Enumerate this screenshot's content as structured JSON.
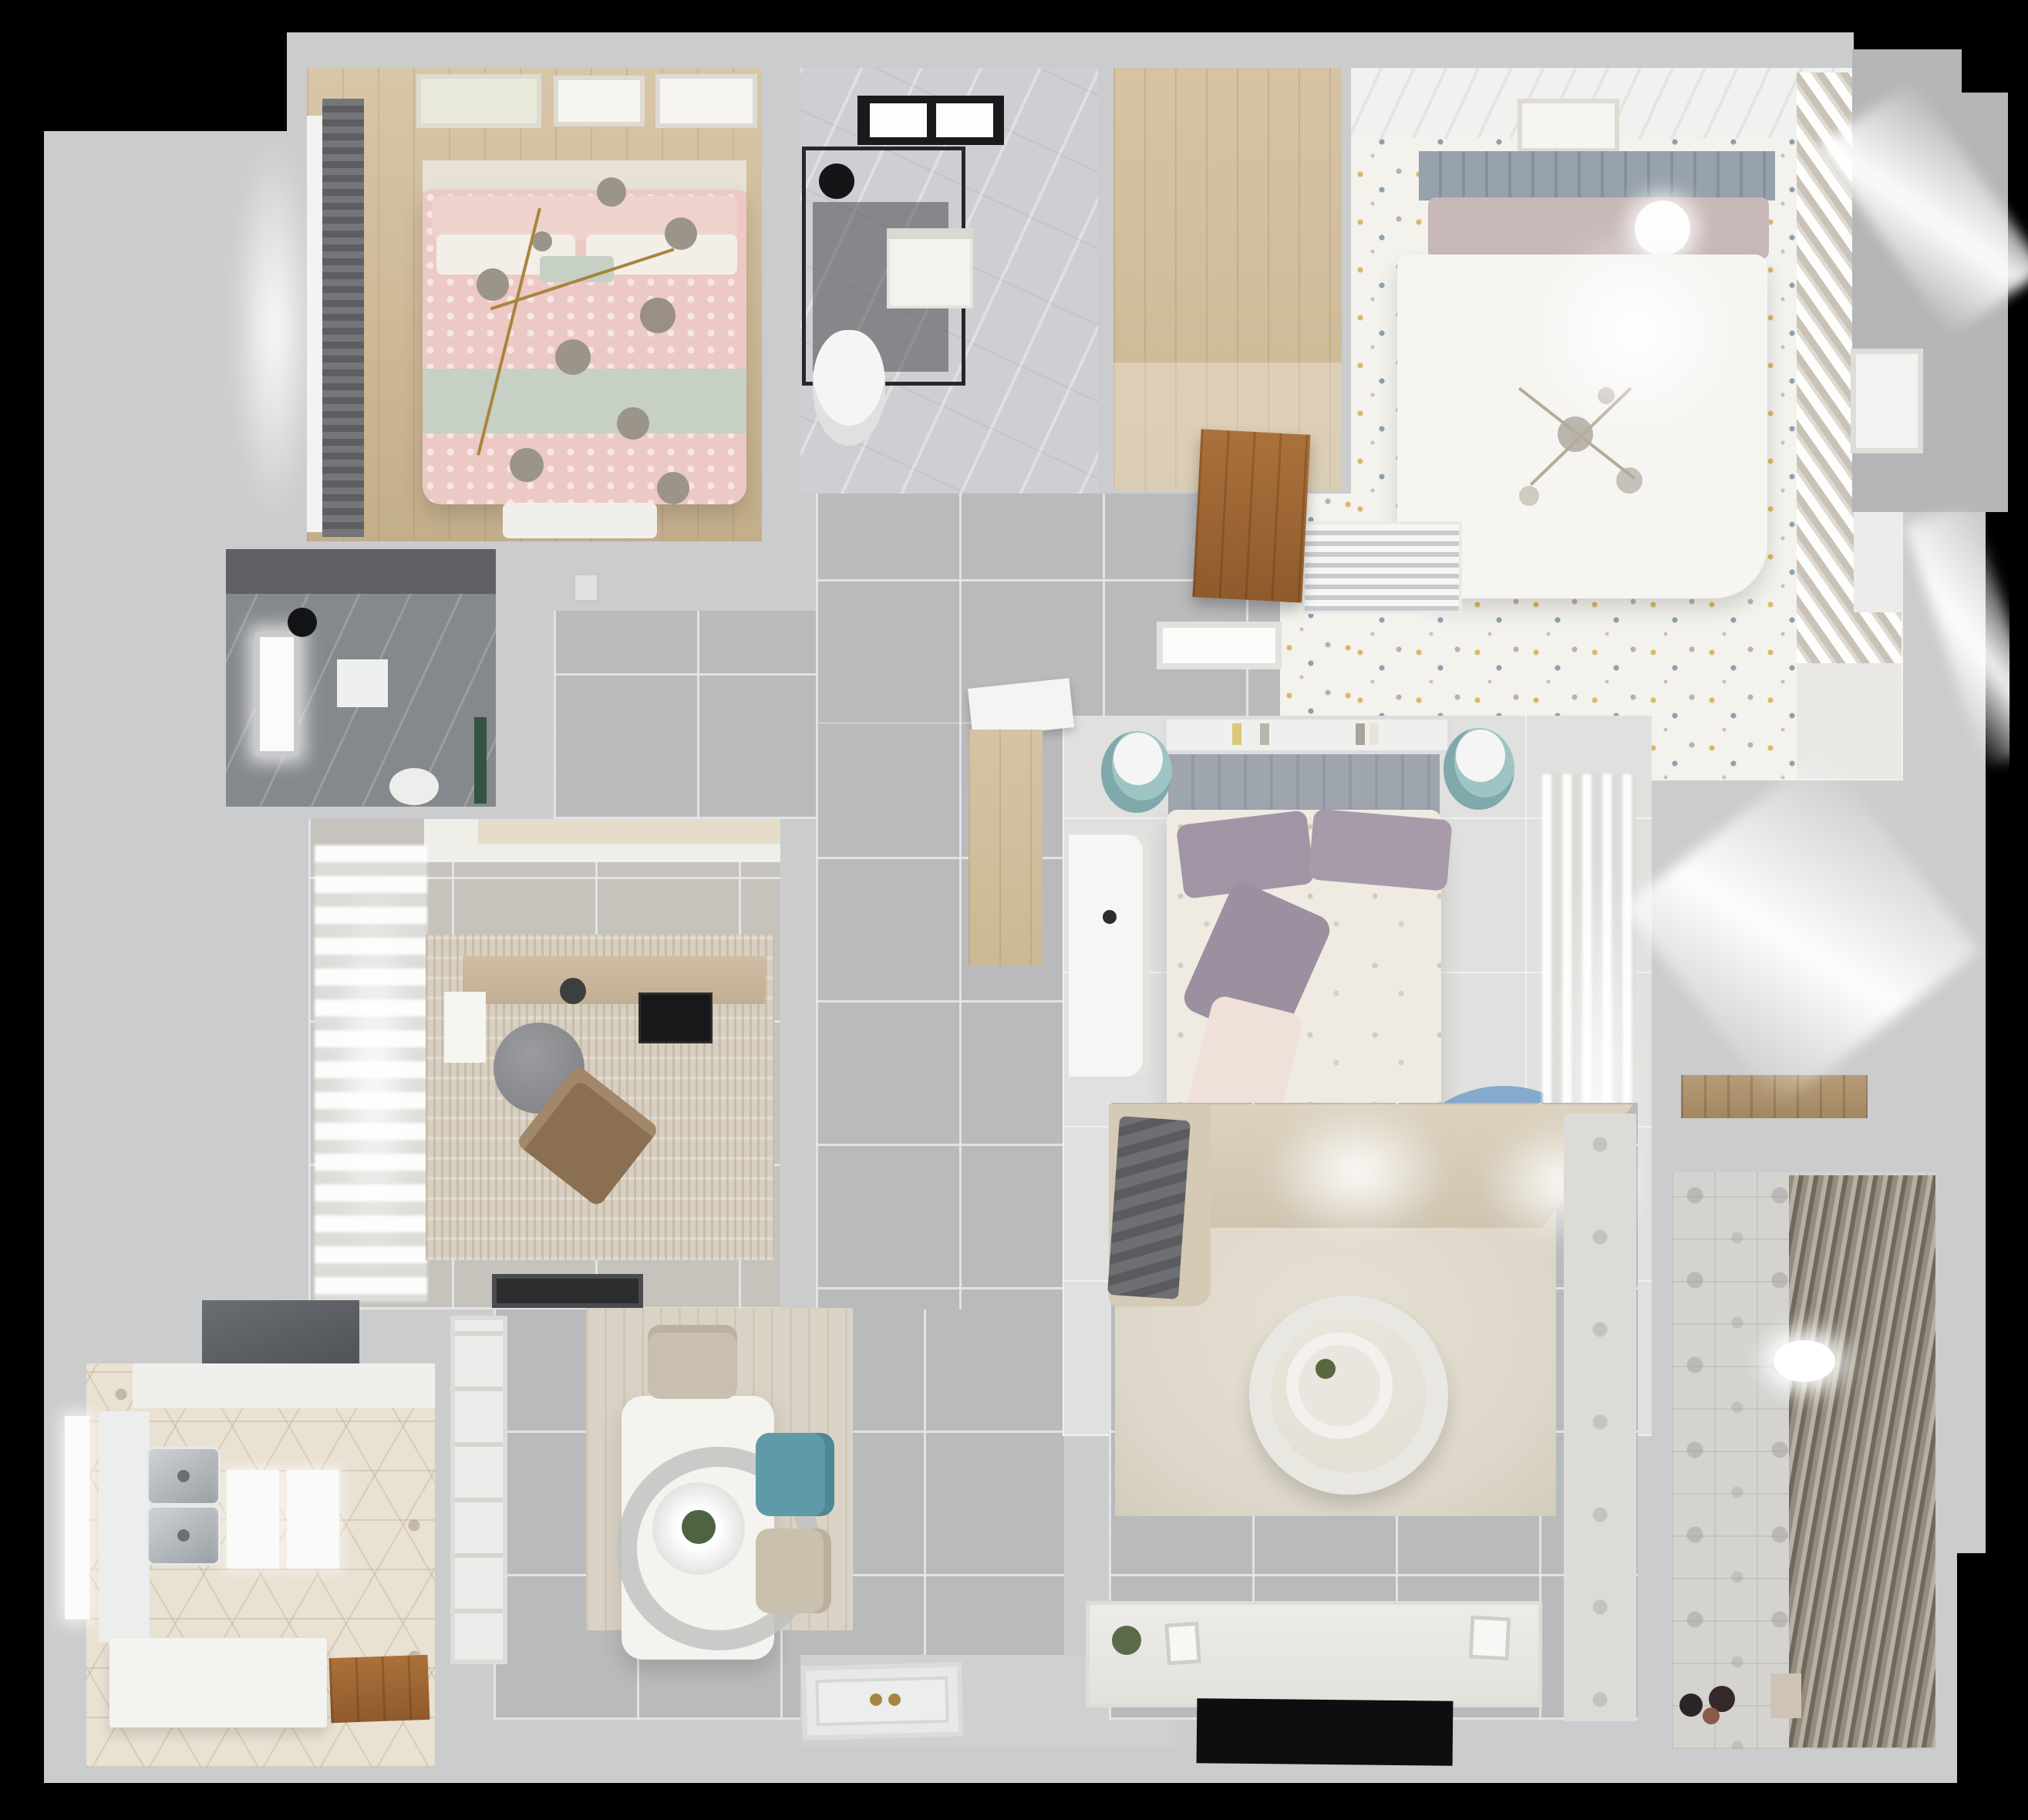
{
  "scene": {
    "title": "Top-down 3D render of an apartment floor plan",
    "type": "architectural-render",
    "background": "#000000"
  },
  "palette": {
    "wall": "#cbccce",
    "corridorTile": "#b9babc",
    "marble": "#cdcfd2",
    "darkBath": "#85888c",
    "confetti": "#f3f2ed",
    "hexFloor": "#e9e1d2",
    "pinkBed": "#ecc9c4",
    "sageBand": "#c7d0c5",
    "tealChair": "#5f9aa8",
    "sofaBeige": "#d5cab6",
    "rugCream": "#ddd7c9",
    "woodDoor": "#ab713b",
    "tvBlack": "#0d0e10",
    "gold": "#a8853f"
  },
  "rooms": {
    "bedroom1": {
      "name": "Bedroom 1 (pink bedding, wood floor)",
      "furniture": [
        "double-bed",
        "pink-duvet",
        "sage-throw",
        "pillows",
        "branch-chandelier",
        "roman-curtain",
        "window",
        "wall-frames",
        "bench"
      ]
    },
    "bathroom1": {
      "name": "Bathroom 1 (marble, shower)",
      "furniture": [
        "glass-shower",
        "black-skylight",
        "shower-head",
        "vanity-unit",
        "toilet"
      ]
    },
    "closet1": {
      "name": "Walk-in closet (wood floor)",
      "furniture": [
        "open-wood-door"
      ]
    },
    "bedroom2": {
      "name": "Bedroom 2 (white bed, confetti floor)",
      "furniture": [
        "double-bed",
        "grey-headboard",
        "ball-lamp",
        "sputnik-chandelier",
        "louvered-wardrobe",
        "wall-frame",
        "ac-vent",
        "wood-dresser",
        "display-shelf"
      ]
    },
    "bedroom3": {
      "name": "Bedroom 3 (middle, floral duvet)",
      "furniture": [
        "double-bed",
        "purple-pillows",
        "book-shelf",
        "teal-stool-left",
        "teal-stool-right",
        "white-desk",
        "circle-rug",
        "sheer-curtains",
        "wood-entry-niche"
      ]
    },
    "office": {
      "name": "Study / office",
      "furniture": [
        "l-desk",
        "black-monitor",
        "round-grey-chair",
        "brown-lounge-chair",
        "textured-rug",
        "sheer-curtains",
        "doormat",
        "top-cabinet"
      ]
    },
    "bathroom2": {
      "name": "Bathroom 2 (dark tile)",
      "furniture": [
        "window",
        "shower-head",
        "wall-shelf",
        "toilet",
        "green-accent"
      ]
    },
    "kitchen": {
      "name": "Kitchen (hex tile)",
      "furniture": [
        "range-hood",
        "upper-cabinets",
        "double-sink",
        "window",
        "l-counter",
        "wood-door",
        "splash-panels"
      ]
    },
    "dining": {
      "name": "Dining area",
      "furniture": [
        "white-table",
        "oval-pendant-lamp",
        "plant-centerpiece",
        "beige-chair-top",
        "teal-chair",
        "beige-chair-bottom",
        "china-cabinet",
        "area-rug"
      ]
    },
    "living": {
      "name": "Living room",
      "furniture": [
        "corner-sofa",
        "grey-throw",
        "cream-rug",
        "round-coffee-table",
        "tv-console",
        "flat-tv",
        "decor-vase",
        "patterned-threshold"
      ]
    },
    "balcony": {
      "name": "Balcony / laundry",
      "furniture": [
        "venetian-blinds",
        "ceiling-lamp",
        "floor-toys",
        "storage-box",
        "patterned-tile"
      ]
    },
    "corridor": {
      "name": "Hallway / entry",
      "furniture": [
        "front-door",
        "door-mat",
        "grey-floor-tiles"
      ]
    },
    "exterior": {
      "name": "Structural / exterior areas",
      "furniture": [
        "side-door",
        "light-bleed"
      ]
    }
  }
}
